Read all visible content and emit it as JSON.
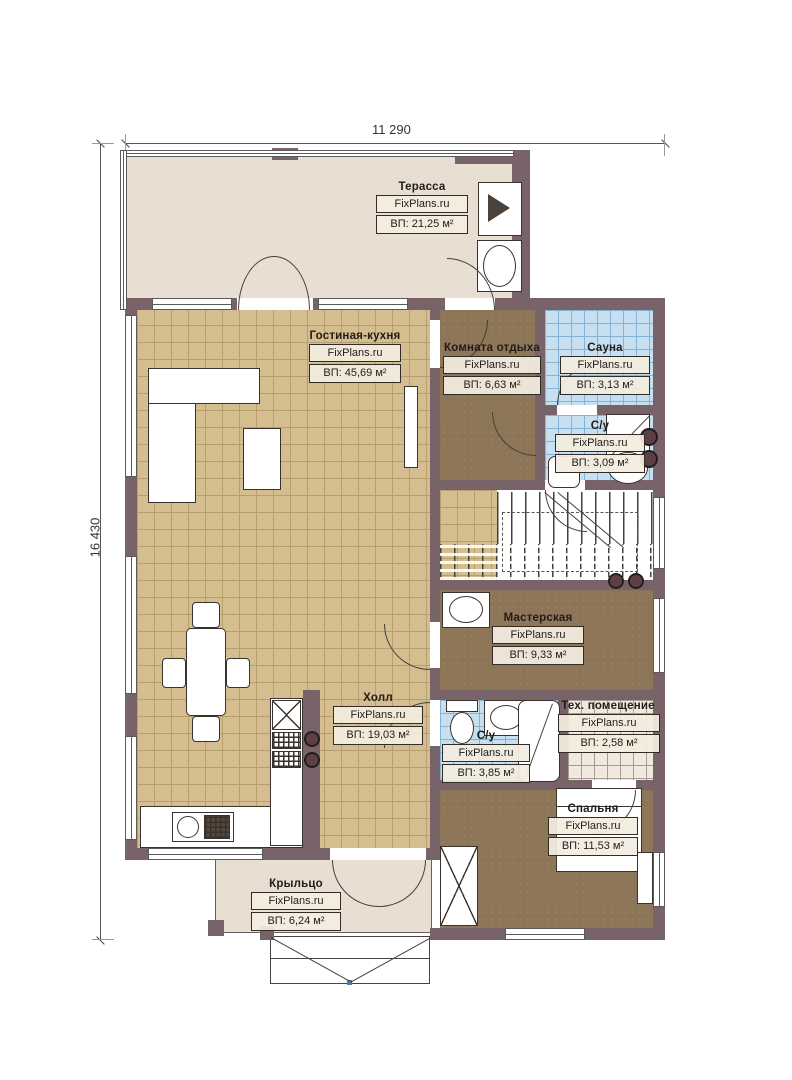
{
  "plan": {
    "brand": "FixPlans.ru",
    "dimensions": {
      "width_label": "11 290",
      "height_label": "16 430"
    },
    "rooms": [
      {
        "id": "terrace",
        "name": "Терасса",
        "brand": "FixPlans.ru",
        "area": "ВП: 21,25 м²"
      },
      {
        "id": "living",
        "name": "Гостиная-кухня",
        "brand": "FixPlans.ru",
        "area": "ВП: 45,69 м²"
      },
      {
        "id": "lounge",
        "name": "Комната отдыха",
        "brand": "FixPlans.ru",
        "area": "ВП: 6,63 м²"
      },
      {
        "id": "sauna",
        "name": "Сауна",
        "brand": "FixPlans.ru",
        "area": "ВП: 3,13 м²"
      },
      {
        "id": "wc1",
        "name": "С/у",
        "brand": "FixPlans.ru",
        "area": "ВП: 3,09 м²"
      },
      {
        "id": "workshop",
        "name": "Мастерская",
        "brand": "FixPlans.ru",
        "area": "ВП: 9,33 м²"
      },
      {
        "id": "hall",
        "name": "Холл",
        "brand": "FixPlans.ru",
        "area": "ВП: 19,03 м²"
      },
      {
        "id": "wc2",
        "name": "С/у",
        "brand": "FixPlans.ru",
        "area": "ВП: 3,85 м²"
      },
      {
        "id": "tech",
        "name": "Тех. помещение",
        "brand": "FixPlans.ru",
        "area": "ВП: 2,58 м²"
      },
      {
        "id": "bedroom",
        "name": "Спальня",
        "brand": "FixPlans.ru",
        "area": "ВП: 11,53 м²"
      },
      {
        "id": "porch",
        "name": "Крыльцо",
        "brand": "FixPlans.ru",
        "area": "ВП: 6,24 м²"
      }
    ],
    "colors": {
      "wall": "#786368",
      "tile_floor": "#d4bd8f",
      "wet_floor": "#c6e0f2",
      "wood_room": "#8d7558",
      "deck": "#e8ded2",
      "label_bg": "#f3ede0",
      "line": "#3a322d"
    }
  }
}
